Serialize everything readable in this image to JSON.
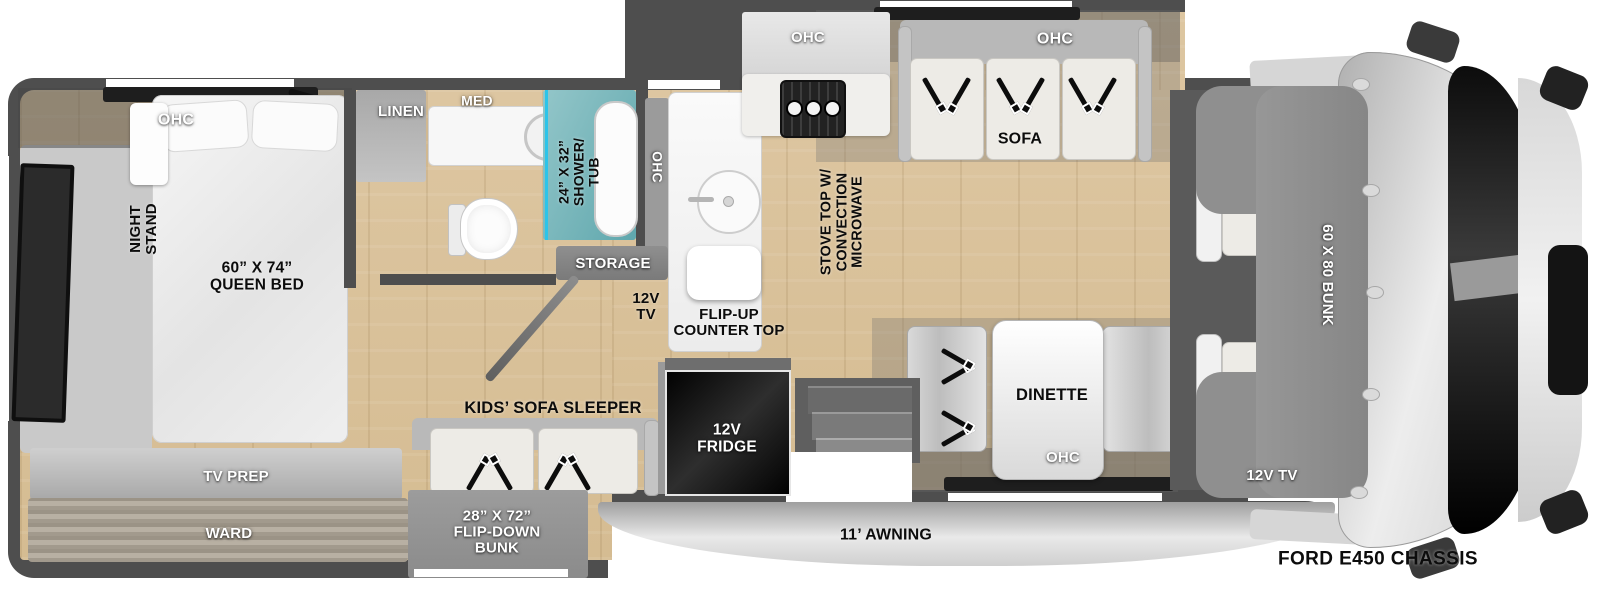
{
  "colors": {
    "wall": "#4e4e4e",
    "wood": "#d9c29b",
    "shower_teal": "#7ab9bd",
    "shower_line": "#2cc4e9",
    "slide_rail": "#1e1e1e",
    "fridge_black": "#0a0a0a"
  },
  "labels": {
    "bedroom_ohc": "OHC",
    "night_stand": "NIGHT\nSTAND",
    "queen_bed": "60” X 74”\nQUEEN BED",
    "tv_prep": "TV PREP",
    "ward": "WARD",
    "linen": "LINEN",
    "med": "MED",
    "shower_tub": "24” X 32”\nSHOWER/\nTUB",
    "galley_ohc_side": "OHC",
    "storage": "STORAGE",
    "galley_tv": "12V\nTV",
    "flip_up_counter": "FLIP-UP\nCOUNTER TOP",
    "galley_ohc_top": "OHC",
    "stove": "STOVE TOP W/\nCONVECTION\nMICROWAVE",
    "sofa_ohc": "OHC",
    "sofa": "SOFA",
    "dinette": "DINETTE",
    "dinette_ohc": "OHC",
    "kids_sofa": "KIDS’ SOFA SLEEPER",
    "flip_down_bunk": "28” X 72”\nFLIP-DOWN\nBUNK",
    "fridge": "12V\nFRIDGE",
    "awning": "11’ AWNING",
    "bunk": "60 X 80 BUNK",
    "bunk_tv": "12V TV",
    "chassis": "FORD E450 CHASSIS"
  }
}
